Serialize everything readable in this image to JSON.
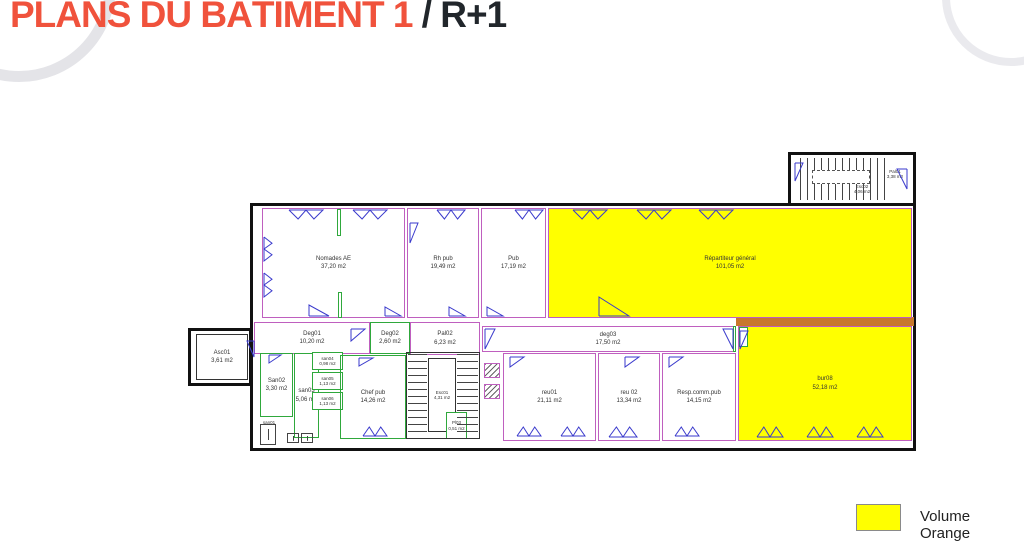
{
  "title": {
    "main": "PLANS DU BÂTIMENT 1",
    "separator": " / ",
    "level": "R+1"
  },
  "legend": {
    "label": "Volume Orange",
    "swatch_color": "#ffff00"
  },
  "colors": {
    "accent_orange_title": "#f0523c",
    "volume_orange_fill": "#ffff00",
    "wall_pink": "#bf5fbf",
    "wall_green": "#2fa83c",
    "door_blue": "#3a3acc",
    "band_orange": "#c8782d",
    "envelope_black": "#111111"
  },
  "plan": {
    "annexes": [
      {
        "id": "building-envelope",
        "x": 250,
        "y": 203,
        "w": 666,
        "h": 248,
        "stroke": "#111111",
        "sw": 3,
        "fill": "none"
      },
      {
        "id": "stair-annex-top-right",
        "x": 788,
        "y": 152,
        "w": 128,
        "h": 54,
        "stroke": "#111111",
        "sw": 3,
        "fill": "#ffffff"
      },
      {
        "id": "elevator-annex-left",
        "x": 188,
        "y": 328,
        "w": 64,
        "h": 58,
        "stroke": "#111111",
        "sw": 3,
        "fill": "#ffffff"
      }
    ],
    "band": {
      "id": "orange-corridor-band",
      "x": 736,
      "y": 317,
      "w": 178,
      "h": 9,
      "fill": "#c8782d"
    },
    "rooms": [
      {
        "id": "nomades-ae",
        "label": "Nomades AE",
        "area": "37,20 m2",
        "x": 262,
        "y": 208,
        "w": 143,
        "h": 110,
        "fill": "#ffffff",
        "stroke": "#bf5fbf"
      },
      {
        "id": "rh-pub",
        "label": "Rh pub",
        "area": "19,49 m2",
        "x": 407,
        "y": 208,
        "w": 72,
        "h": 110,
        "fill": "#ffffff",
        "stroke": "#bf5fbf"
      },
      {
        "id": "pub",
        "label": "Pub",
        "area": "17,19 m2",
        "x": 481,
        "y": 208,
        "w": 65,
        "h": 110,
        "fill": "#ffffff",
        "stroke": "#bf5fbf"
      },
      {
        "id": "repartiteur-general",
        "label": "Répartiteur général",
        "area": "101,05 m2",
        "x": 548,
        "y": 208,
        "w": 364,
        "h": 110,
        "fill": "#ffff00",
        "stroke": "#bf5fbf"
      },
      {
        "id": "deg01",
        "label": "Deg01",
        "area": "10,20 m2",
        "x": 254,
        "y": 322,
        "w": 116,
        "h": 32,
        "fill": "none",
        "stroke": "#bf5fbf"
      },
      {
        "id": "deg02",
        "label": "Deg02",
        "area": "2,60 m2",
        "x": 370,
        "y": 322,
        "w": 40,
        "h": 32,
        "fill": "none",
        "stroke": "#2fa83c"
      },
      {
        "id": "pal02",
        "label": "Pal02",
        "area": "6,23 m2",
        "x": 410,
        "y": 322,
        "w": 70,
        "h": 33,
        "fill": "none",
        "stroke": "#bf5fbf"
      },
      {
        "id": "deg03",
        "label": "deg03",
        "area": "17,50 m2",
        "x": 482,
        "y": 326,
        "w": 252,
        "h": 26,
        "fill": "#ffffff",
        "stroke": "#bf5fbf"
      },
      {
        "id": "asc01",
        "label": "Asc01",
        "area": "3,61 m2",
        "x": 196,
        "y": 334,
        "w": 52,
        "h": 46,
        "fill": "#ffffff",
        "stroke": "#333333"
      },
      {
        "id": "san02",
        "label": "San02",
        "area": "3,30 m2",
        "x": 260,
        "y": 353,
        "w": 33,
        "h": 64,
        "fill": "none",
        "stroke": "#2fa83c"
      },
      {
        "id": "san03",
        "label": "san03",
        "area": "5,06 m2",
        "x": 294,
        "y": 353,
        "w": 25,
        "h": 85,
        "fill": "none",
        "stroke": "#2fa83c"
      },
      {
        "id": "san04",
        "label": "san04",
        "area": "0,98 m2",
        "x": 312,
        "y": 352,
        "w": 31,
        "h": 18,
        "fill": "#ffffff",
        "stroke": "#2fa83c",
        "small": true
      },
      {
        "id": "san05",
        "label": "san05",
        "area": "1,13 m2",
        "x": 312,
        "y": 372,
        "w": 31,
        "h": 18,
        "fill": "#ffffff",
        "stroke": "#2fa83c",
        "small": true
      },
      {
        "id": "san06",
        "label": "san06",
        "area": "1,13 m2",
        "x": 312,
        "y": 392,
        "w": 31,
        "h": 18,
        "fill": "#ffffff",
        "stroke": "#2fa83c",
        "small": true
      },
      {
        "id": "chef-pub",
        "label": "Chef pub",
        "area": "14,26 m2",
        "x": 340,
        "y": 355,
        "w": 66,
        "h": 84,
        "fill": "none",
        "stroke": "#2fa83c"
      },
      {
        "id": "esc01",
        "label": "Esc01",
        "area": "4,31 m2",
        "x": 428,
        "y": 358,
        "w": 28,
        "h": 74,
        "fill": "#ffffff",
        "stroke": "#333333",
        "small": true
      },
      {
        "id": "pl03",
        "label": "Pl03",
        "area": "0,51 m2",
        "x": 446,
        "y": 412,
        "w": 21,
        "h": 27,
        "fill": "#ffffff",
        "stroke": "#2fa83c",
        "small": true
      },
      {
        "id": "reu01",
        "label": "reu01",
        "area": "21,11 m2",
        "x": 503,
        "y": 353,
        "w": 93,
        "h": 88,
        "fill": "none",
        "stroke": "#bf5fbf"
      },
      {
        "id": "reu02",
        "label": "reu 02",
        "area": "13,34 m2",
        "x": 598,
        "y": 353,
        "w": 62,
        "h": 88,
        "fill": "none",
        "stroke": "#bf5fbf"
      },
      {
        "id": "resp-comm-pub",
        "label": "Resp.comm.pub",
        "area": "14,15 m2",
        "x": 662,
        "y": 353,
        "w": 74,
        "h": 88,
        "fill": "none",
        "stroke": "#bf5fbf"
      },
      {
        "id": "bur08",
        "label": "bur08",
        "area": "52,18 m2",
        "x": 738,
        "y": 326,
        "w": 174,
        "h": 115,
        "fill": "#ffff00",
        "stroke": "#bf5fbf"
      },
      {
        "id": "pal01",
        "label": "Pal01",
        "area": "3,38 m2",
        "x": 878,
        "y": 163,
        "w": 34,
        "h": 22,
        "fill": "none",
        "stroke": "none",
        "small": true
      },
      {
        "id": "esc02",
        "label": "Esc02",
        "area": "4,06 m2",
        "x": 845,
        "y": 178,
        "w": 34,
        "h": 22,
        "fill": "none",
        "stroke": "none",
        "small": true
      },
      {
        "id": "san01",
        "label": "san01",
        "area": "",
        "x": 258,
        "y": 418,
        "w": 22,
        "h": 10,
        "fill": "none",
        "stroke": "none",
        "small": true
      }
    ],
    "stairs": [
      {
        "x": 406,
        "y": 352,
        "w": 74,
        "h": 87,
        "kind": "box"
      },
      {
        "x": 408,
        "y": 354,
        "w": 19,
        "h": 83,
        "kind": "treads-h"
      },
      {
        "x": 457,
        "y": 354,
        "w": 21,
        "h": 83,
        "kind": "treads-h"
      },
      {
        "x": 800,
        "y": 158,
        "w": 90,
        "h": 42,
        "kind": "treads-v"
      },
      {
        "x": 812,
        "y": 170,
        "w": 58,
        "h": 14,
        "kind": "dashedbox"
      }
    ],
    "accents": [
      {
        "x": 337,
        "y": 209,
        "w": 4,
        "h": 27
      },
      {
        "x": 338,
        "y": 292,
        "w": 4,
        "h": 26
      },
      {
        "x": 733,
        "y": 326,
        "w": 3,
        "h": 26
      },
      {
        "x": 739,
        "y": 327,
        "w": 9,
        "h": 20
      }
    ],
    "ducts": [
      {
        "x": 484,
        "y": 363,
        "w": 16,
        "h": 15
      },
      {
        "x": 484,
        "y": 384,
        "w": 16,
        "h": 15
      }
    ],
    "doors": [
      {
        "x": 288,
        "y": 209,
        "w": 36,
        "h": 11,
        "dir": "down",
        "kind": "double"
      },
      {
        "x": 352,
        "y": 209,
        "w": 36,
        "h": 11,
        "dir": "down",
        "kind": "double"
      },
      {
        "x": 436,
        "y": 209,
        "w": 30,
        "h": 11,
        "dir": "down",
        "kind": "double"
      },
      {
        "x": 514,
        "y": 209,
        "w": 30,
        "h": 11,
        "dir": "down",
        "kind": "double"
      },
      {
        "x": 572,
        "y": 209,
        "w": 36,
        "h": 11,
        "dir": "down",
        "kind": "double"
      },
      {
        "x": 636,
        "y": 209,
        "w": 36,
        "h": 11,
        "dir": "down",
        "kind": "double"
      },
      {
        "x": 698,
        "y": 209,
        "w": 36,
        "h": 11,
        "dir": "down",
        "kind": "double"
      },
      {
        "x": 263,
        "y": 236,
        "w": 10,
        "h": 26,
        "dir": "right",
        "kind": "double"
      },
      {
        "x": 263,
        "y": 272,
        "w": 10,
        "h": 26,
        "dir": "right",
        "kind": "double"
      },
      {
        "x": 409,
        "y": 222,
        "w": 10,
        "h": 22,
        "dir": "right",
        "kind": "single"
      },
      {
        "x": 308,
        "y": 304,
        "w": 22,
        "h": 13,
        "dir": "up",
        "kind": "single"
      },
      {
        "x": 384,
        "y": 306,
        "w": 18,
        "h": 11,
        "dir": "up",
        "kind": "single"
      },
      {
        "x": 448,
        "y": 306,
        "w": 18,
        "h": 11,
        "dir": "up",
        "kind": "single"
      },
      {
        "x": 486,
        "y": 306,
        "w": 18,
        "h": 11,
        "dir": "up",
        "kind": "single"
      },
      {
        "x": 598,
        "y": 296,
        "w": 32,
        "h": 21,
        "dir": "up",
        "kind": "single"
      },
      {
        "x": 350,
        "y": 328,
        "w": 16,
        "h": 14,
        "dir": "down",
        "kind": "single"
      },
      {
        "x": 484,
        "y": 328,
        "w": 12,
        "h": 22,
        "dir": "right",
        "kind": "single"
      },
      {
        "x": 722,
        "y": 328,
        "w": 12,
        "h": 22,
        "dir": "left",
        "kind": "single"
      },
      {
        "x": 268,
        "y": 354,
        "w": 14,
        "h": 10,
        "dir": "down",
        "kind": "single"
      },
      {
        "x": 358,
        "y": 357,
        "w": 16,
        "h": 10,
        "dir": "down",
        "kind": "single"
      },
      {
        "x": 362,
        "y": 426,
        "w": 26,
        "h": 11,
        "dir": "up",
        "kind": "double"
      },
      {
        "x": 509,
        "y": 356,
        "w": 16,
        "h": 12,
        "dir": "down",
        "kind": "single"
      },
      {
        "x": 516,
        "y": 426,
        "w": 26,
        "h": 11,
        "dir": "up",
        "kind": "double"
      },
      {
        "x": 560,
        "y": 426,
        "w": 26,
        "h": 11,
        "dir": "up",
        "kind": "double"
      },
      {
        "x": 624,
        "y": 356,
        "w": 16,
        "h": 12,
        "dir": "down",
        "kind": "single"
      },
      {
        "x": 608,
        "y": 426,
        "w": 30,
        "h": 12,
        "dir": "up",
        "kind": "double"
      },
      {
        "x": 668,
        "y": 356,
        "w": 16,
        "h": 12,
        "dir": "down",
        "kind": "single"
      },
      {
        "x": 674,
        "y": 426,
        "w": 26,
        "h": 11,
        "dir": "up",
        "kind": "double"
      },
      {
        "x": 739,
        "y": 330,
        "w": 10,
        "h": 20,
        "dir": "right",
        "kind": "single"
      },
      {
        "x": 756,
        "y": 426,
        "w": 28,
        "h": 12,
        "dir": "up",
        "kind": "double"
      },
      {
        "x": 806,
        "y": 426,
        "w": 28,
        "h": 12,
        "dir": "up",
        "kind": "double"
      },
      {
        "x": 856,
        "y": 426,
        "w": 28,
        "h": 12,
        "dir": "up",
        "kind": "double"
      },
      {
        "x": 246,
        "y": 340,
        "w": 9,
        "h": 18,
        "dir": "left",
        "kind": "single"
      },
      {
        "x": 794,
        "y": 162,
        "w": 10,
        "h": 20,
        "dir": "right",
        "kind": "single"
      },
      {
        "x": 896,
        "y": 168,
        "w": 12,
        "h": 22,
        "dir": "left",
        "kind": "single"
      }
    ],
    "fixtures": [
      {
        "x": 260,
        "y": 424,
        "w": 16,
        "h": 21
      },
      {
        "x": 287,
        "y": 433,
        "w": 12,
        "h": 10
      },
      {
        "x": 301,
        "y": 433,
        "w": 12,
        "h": 10
      }
    ]
  }
}
